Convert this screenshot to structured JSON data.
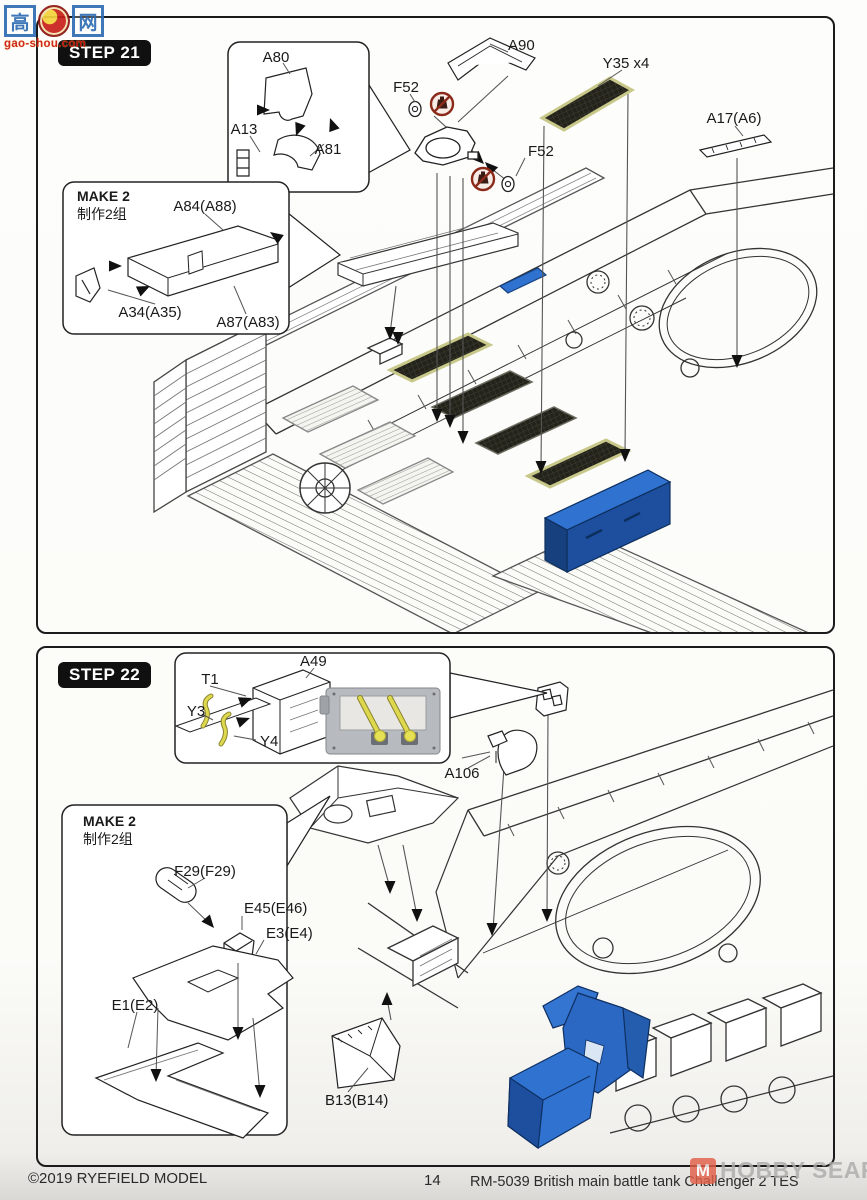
{
  "watermark_gaoshou": {
    "glyph_left": "高",
    "glyph_right": "网",
    "url_text": "gao-shou.com"
  },
  "watermark_hobbysearch": {
    "mark_glyph": "M",
    "text": "HOBBY SEARCH"
  },
  "footer": {
    "copyright": "©2019 RYEFIELD MODEL",
    "page": "14",
    "kit": "RM-5039 British main battle tank Challenger 2 TES"
  },
  "colors": {
    "highlight_blue": "#2f72cf",
    "highlight_blue_dark": "#1d4f9e",
    "mesh_dark": "#23231b",
    "mesh_frame_olive": "#c8c88a",
    "no_glue_red": "#8c2a1a",
    "cable_yellow": "#ddd84e",
    "line_art": "#333333"
  },
  "step21": {
    "badge": "STEP 21",
    "make2_note_en": "MAKE 2",
    "make2_note_cn": "制作2组",
    "labels": {
      "a80": "A80",
      "a13": "A13",
      "a81": "A81",
      "a90": "A90",
      "f52a": "F52",
      "f52b": "F52",
      "y35": "Y35 x4",
      "a17": "A17(A6)",
      "a84": "A84(A88)",
      "a34": "A34(A35)",
      "a87": "A87(A83)"
    }
  },
  "step22": {
    "badge": "STEP 22",
    "make2_note_en": "MAKE 2",
    "make2_note_cn": "制作2组",
    "labels": {
      "a49": "A49",
      "t1": "T1",
      "y3": "Y3",
      "y4": "Y4",
      "a106": "A106",
      "b13": "B13(B14)",
      "f29": "F29(F29)",
      "e45": "E45(E46)",
      "e3": "E3(E4)",
      "e1": "E1(E2)"
    }
  }
}
